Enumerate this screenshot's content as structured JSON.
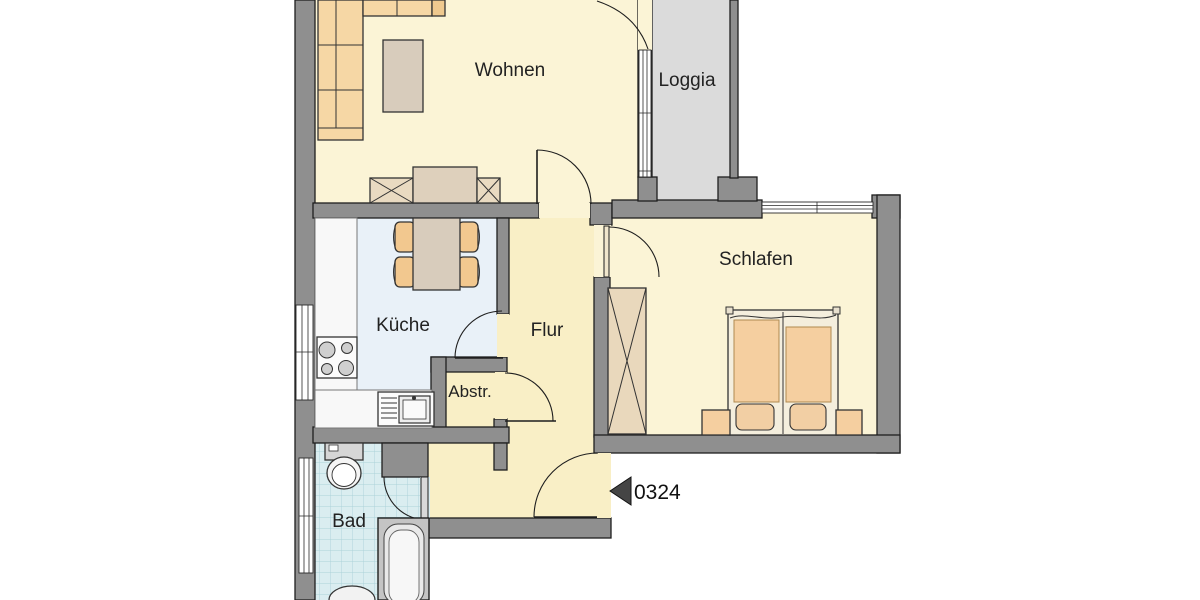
{
  "plan": {
    "type": "apartment-floor-plan",
    "rooms": {
      "wohnen": {
        "label": "Wohnen"
      },
      "loggia": {
        "label": "Loggia"
      },
      "kueche": {
        "label": "Küche"
      },
      "flur": {
        "label": "Flur"
      },
      "abstellraum": {
        "label": "Abstr."
      },
      "schlafen": {
        "label": "Schlafen"
      },
      "bad": {
        "label": "Bad"
      }
    },
    "entrance": {
      "unit_number": "0324",
      "arrow_icon": "left-arrow"
    },
    "colors": {
      "wall_gray": "#8F8F8F",
      "outline_black": "#1E1E1E",
      "living_floor_cream": "#FBF4D6",
      "hall_floor_cream": "#F9EFC6",
      "kitchen_floor_blue": "#E9F1F8",
      "bath_floor_cyan": "#DAEDF0",
      "bath_tile_line": "#ACD2D9",
      "loggia_floor_gray": "#DBDBDB",
      "furniture_orange": "#F6D7A5",
      "furniture_tan": "#D8CCBC",
      "cabinet_tan": "#E9D8BC",
      "fixture_white": "#F8F8F8"
    }
  }
}
